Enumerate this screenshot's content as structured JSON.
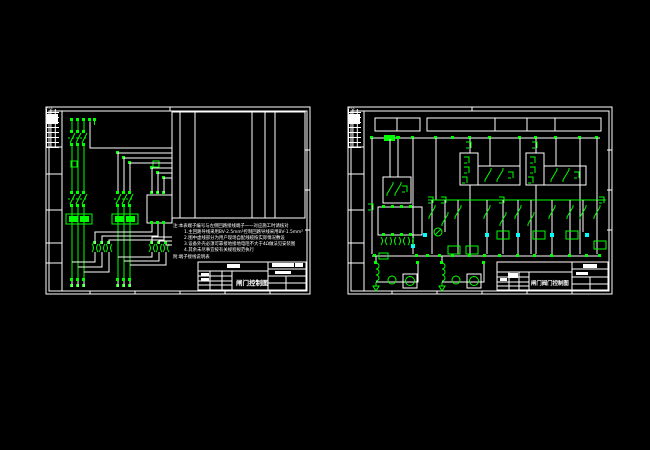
{
  "colors": {
    "background": "#000000",
    "frame_lines": "#ffffff",
    "circuit_green": "#00ff00",
    "highlight_cyan": "#00ffff"
  },
  "left_sheet": {
    "zone_label": "F.T.L",
    "notes": {
      "n0": "注:本表端子编号与左侧回路接线端子一一对应施工时请核对",
      "n1": "1.主回路导线采用BV-2.5mm²控制回路导线采用BV-1.5mm²",
      "n2": "2.图中虚线部分为用户现场自配线缆按实际情况敷设",
      "n3": "3.设备外壳必须可靠接地接地电阻不大于4Ω做法见安装图",
      "n4": "4.其余未尽事宜按有关规程规范执行"
    },
    "footnote": "附:端子接线说明表",
    "title_block": {
      "title": "闸门控制图"
    }
  },
  "right_sheet": {
    "zone_label": "F.T.L",
    "title_block": {
      "title": "闸门阀门控制图"
    }
  }
}
